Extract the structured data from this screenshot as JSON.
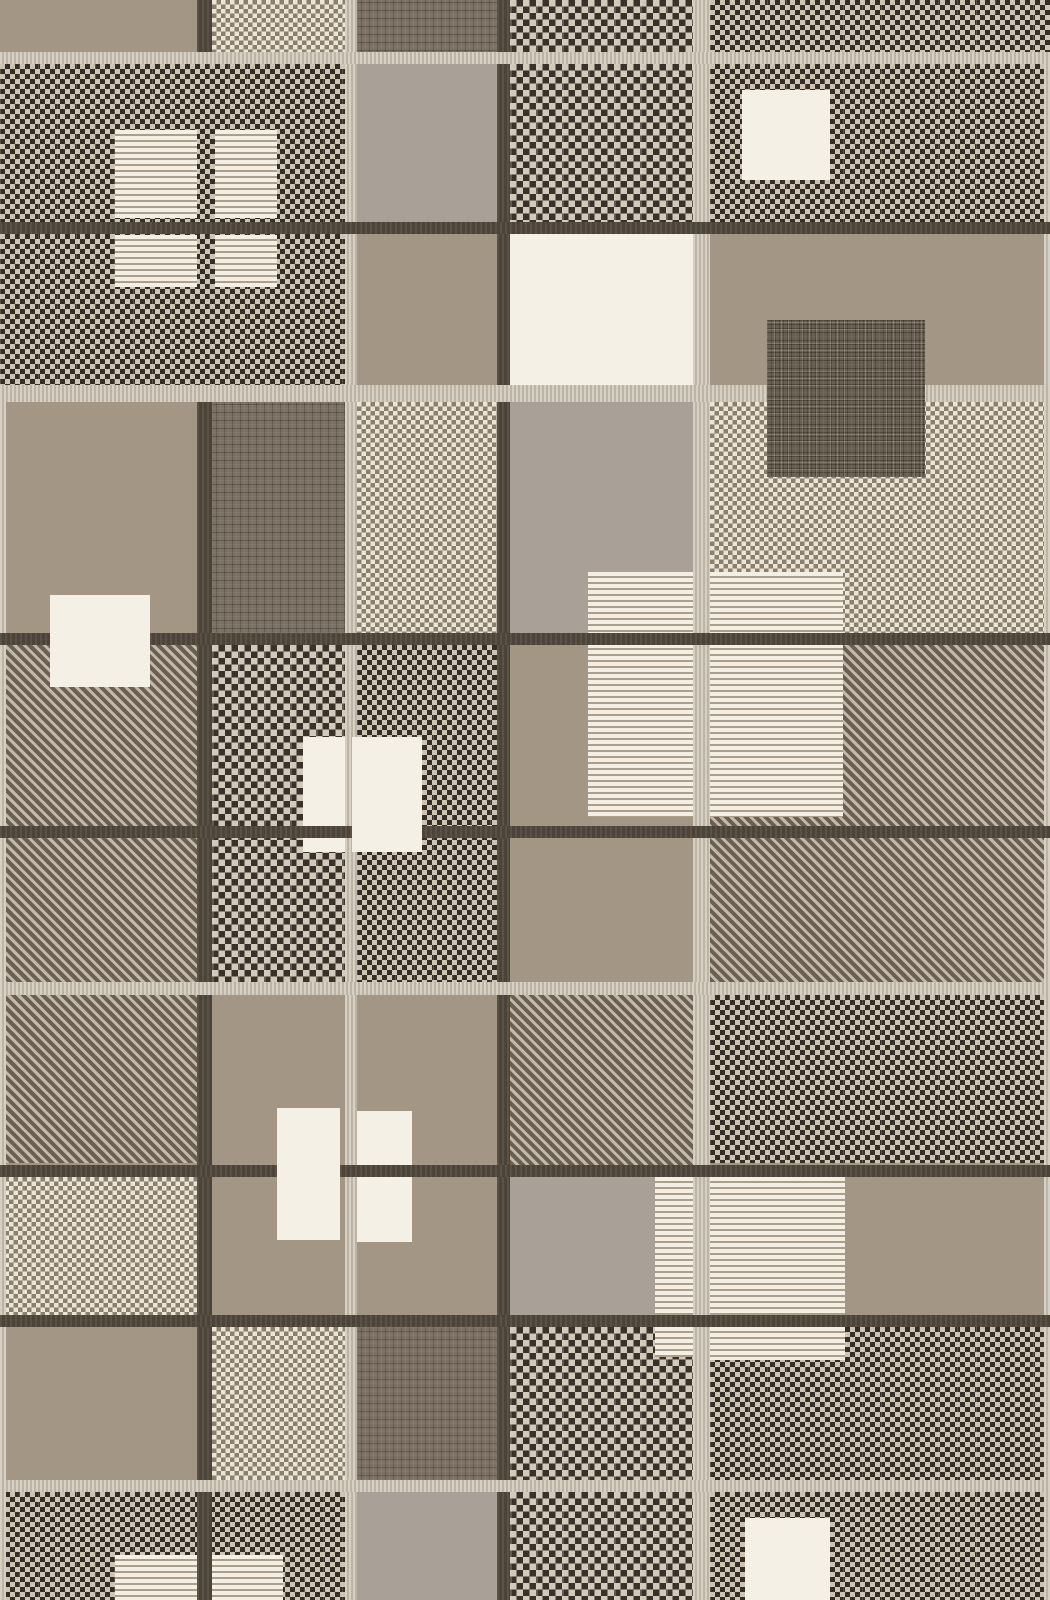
{
  "image": {
    "kind": "photograph-of-textile",
    "subject": "flat-woven plaid patchwork rug in taupe, cream and dark brown",
    "width_px": 1050,
    "height_px": 1600,
    "visible_text": "none"
  },
  "palette": {
    "taupe_solid": "#a39685",
    "gray_solid": "#a9a097",
    "cream_solid": "#f5f0e6",
    "stripe_cream": "#f4efe4",
    "stripe_gap": "#ab9f8c",
    "checker_dark_cell": "#352e26",
    "checker_light_cell": "#cdc4b5",
    "light_checker_dot": "#8b7f70",
    "twill_dark": "#6b5f51",
    "twill_light": "#c3b9aa",
    "crosshatch_base": "#7c7164",
    "crosshatch_dark_rect": "#695f52",
    "light_band": "#cbc3b5",
    "dark_band": "#4d4439"
  },
  "textures_legend": {
    "taupe": "solid taupe weave",
    "gray": "solid greige weave",
    "cream": "solid off-white patch",
    "stripe": "cream patch with horizontal taupe pinstripes",
    "checkd": "small dark-and-cream checkerboard weave",
    "checkb": "larger dark-and-cream checkerboard weave with seams",
    "checkl": "cream-dominant light checkerboard weave",
    "twill": "diagonal twill weave",
    "cross": "crosshatch grid weave",
    "crossd": "dark crosshatch grid patch",
    "bandl": "ribbed light weft band",
    "bandd": "dark brown weft band",
    "vlight": "ribbed light warp line",
    "vdark": "dark brown warp line"
  },
  "blocks": [
    {
      "name": "r1-colA-taupe",
      "x": 0,
      "y": 0,
      "w": 197,
      "h": 52,
      "tex": "taupe",
      "z": 1
    },
    {
      "name": "r1-colB-light-checker",
      "x": 212,
      "y": 0,
      "w": 133,
      "h": 52,
      "tex": "checkl",
      "z": 1
    },
    {
      "name": "r1-colC-crosshatch",
      "x": 357,
      "y": 0,
      "w": 140,
      "h": 55,
      "tex": "cross",
      "z": 1
    },
    {
      "name": "r1-colD-big-checker",
      "x": 510,
      "y": 0,
      "w": 183,
      "h": 52,
      "tex": "checkb",
      "z": 1
    },
    {
      "name": "r1-colE-dark-checker",
      "x": 710,
      "y": 0,
      "w": 340,
      "h": 52,
      "tex": "checkd",
      "z": 1
    },
    {
      "name": "r2r3-colAB-dark-checker",
      "x": 0,
      "y": 64,
      "w": 345,
      "h": 321,
      "tex": "checkd",
      "z": 1
    },
    {
      "name": "r2-colC-gray",
      "x": 357,
      "y": 64,
      "w": 140,
      "h": 158,
      "tex": "gray",
      "z": 1
    },
    {
      "name": "r2-colD-big-checker",
      "x": 510,
      "y": 64,
      "w": 183,
      "h": 158,
      "tex": "checkb",
      "z": 1
    },
    {
      "name": "r2-colE-dark-checker",
      "x": 710,
      "y": 64,
      "w": 340,
      "h": 170,
      "tex": "checkd",
      "z": 1
    },
    {
      "name": "r2-colE-cream-square",
      "x": 742,
      "y": 90,
      "w": 88,
      "h": 90,
      "tex": "cream",
      "z": 2
    },
    {
      "name": "top-striped-square-upper-left",
      "x": 115,
      "y": 130,
      "w": 82,
      "h": 88,
      "tex": "stripe",
      "z": 2
    },
    {
      "name": "top-striped-square-upper-right",
      "x": 215,
      "y": 130,
      "w": 62,
      "h": 88,
      "tex": "stripe",
      "z": 2
    },
    {
      "name": "top-striped-square-lower-left",
      "x": 115,
      "y": 235,
      "w": 82,
      "h": 52,
      "tex": "stripe",
      "z": 2
    },
    {
      "name": "top-striped-square-lower-right",
      "x": 215,
      "y": 235,
      "w": 62,
      "h": 52,
      "tex": "stripe",
      "z": 2
    },
    {
      "name": "r3-colC-taupe",
      "x": 357,
      "y": 234,
      "w": 140,
      "h": 168,
      "tex": "taupe",
      "z": 1
    },
    {
      "name": "r3-colD-big-cream-square",
      "x": 505,
      "y": 234,
      "w": 188,
      "h": 151,
      "tex": "cream",
      "z": 2
    },
    {
      "name": "r3-colE-taupe",
      "x": 710,
      "y": 234,
      "w": 340,
      "h": 151,
      "tex": "taupe",
      "z": 1
    },
    {
      "name": "colE-dark-crosshatch-rect",
      "x": 767,
      "y": 320,
      "w": 158,
      "h": 157,
      "tex": "crossd",
      "z": 4
    },
    {
      "name": "r4-colA-taupe",
      "x": 0,
      "y": 402,
      "w": 197,
      "h": 231,
      "tex": "taupe",
      "z": 1
    },
    {
      "name": "r4-colB-crosshatch",
      "x": 212,
      "y": 402,
      "w": 133,
      "h": 231,
      "tex": "cross",
      "z": 1
    },
    {
      "name": "r4-colC-light-checker",
      "x": 357,
      "y": 402,
      "w": 140,
      "h": 231,
      "tex": "checkl",
      "z": 1
    },
    {
      "name": "r4-colD-gray",
      "x": 510,
      "y": 402,
      "w": 183,
      "h": 231,
      "tex": "gray",
      "z": 1
    },
    {
      "name": "r4-colE-light-checker",
      "x": 710,
      "y": 402,
      "w": 340,
      "h": 231,
      "tex": "checkl",
      "z": 1
    },
    {
      "name": "mid-striped-block-left",
      "x": 588,
      "y": 572,
      "w": 105,
      "h": 245,
      "tex": "stripe",
      "z": 2
    },
    {
      "name": "mid-striped-block-right",
      "x": 710,
      "y": 572,
      "w": 133,
      "h": 245,
      "tex": "stripe",
      "z": 2
    },
    {
      "name": "colA-cream-rect",
      "x": 50,
      "y": 595,
      "w": 100,
      "h": 92,
      "tex": "cream",
      "z": 4
    },
    {
      "name": "r5r6-colA-twill",
      "x": 0,
      "y": 645,
      "w": 197,
      "h": 518,
      "tex": "twill",
      "z": 1
    },
    {
      "name": "r5r6-colB-big-checker",
      "x": 212,
      "y": 645,
      "w": 133,
      "h": 337,
      "tex": "checkb",
      "z": 1
    },
    {
      "name": "r5r6-colC-dark-checker",
      "x": 357,
      "y": 645,
      "w": 140,
      "h": 337,
      "tex": "checkd",
      "z": 1
    },
    {
      "name": "r5r6-colD-taupe",
      "x": 510,
      "y": 645,
      "w": 183,
      "h": 337,
      "tex": "taupe",
      "z": 1
    },
    {
      "name": "r5r6-colE-twill",
      "x": 710,
      "y": 645,
      "w": 340,
      "h": 337,
      "tex": "twill",
      "z": 1
    },
    {
      "name": "colB-cream-square-mid",
      "x": 303,
      "y": 737,
      "w": 42,
      "h": 115,
      "tex": "cream",
      "z": 2
    },
    {
      "name": "colC-cream-square-mid",
      "x": 352,
      "y": 737,
      "w": 70,
      "h": 115,
      "tex": "cream",
      "z": 4
    },
    {
      "name": "r7r8-colB-taupe",
      "x": 212,
      "y": 995,
      "w": 133,
      "h": 320,
      "tex": "taupe",
      "z": 1
    },
    {
      "name": "r7r8-colC-taupe",
      "x": 357,
      "y": 995,
      "w": 140,
      "h": 320,
      "tex": "taupe",
      "z": 1
    },
    {
      "name": "r7-colD-twill",
      "x": 510,
      "y": 995,
      "w": 183,
      "h": 170,
      "tex": "twill",
      "z": 1
    },
    {
      "name": "r7-colE-dark-checker",
      "x": 710,
      "y": 995,
      "w": 340,
      "h": 168,
      "tex": "checkd",
      "z": 1
    },
    {
      "name": "colB-cream-square-low",
      "x": 277,
      "y": 1108,
      "w": 63,
      "h": 132,
      "tex": "cream",
      "z": 4
    },
    {
      "name": "colC-cream-square-low",
      "x": 352,
      "y": 1111,
      "w": 60,
      "h": 131,
      "tex": "cream",
      "z": 2
    },
    {
      "name": "r8-colA-light-checker",
      "x": 0,
      "y": 1177,
      "w": 197,
      "h": 138,
      "tex": "checkl",
      "z": 1
    },
    {
      "name": "r8-colD-gray",
      "x": 510,
      "y": 1177,
      "w": 183,
      "h": 138,
      "tex": "gray",
      "z": 1
    },
    {
      "name": "r8-colE-taupe",
      "x": 710,
      "y": 1177,
      "w": 340,
      "h": 138,
      "tex": "taupe",
      "z": 1
    },
    {
      "name": "low-striped-block",
      "x": 710,
      "y": 1177,
      "w": 135,
      "h": 183,
      "tex": "stripe",
      "z": 2
    },
    {
      "name": "low-striped-bar",
      "x": 655,
      "y": 1177,
      "w": 38,
      "h": 180,
      "tex": "stripe",
      "z": 2
    },
    {
      "name": "r9-colA-taupe",
      "x": 0,
      "y": 1327,
      "w": 197,
      "h": 153,
      "tex": "taupe",
      "z": 1
    },
    {
      "name": "r9-colB-light-checker",
      "x": 212,
      "y": 1327,
      "w": 133,
      "h": 153,
      "tex": "checkl",
      "z": 1
    },
    {
      "name": "r9-colC-crosshatch",
      "x": 357,
      "y": 1327,
      "w": 140,
      "h": 153,
      "tex": "cross",
      "z": 1
    },
    {
      "name": "r9-colD-big-checker",
      "x": 510,
      "y": 1327,
      "w": 183,
      "h": 153,
      "tex": "checkb",
      "z": 1
    },
    {
      "name": "r9-colE-dark-checker",
      "x": 710,
      "y": 1327,
      "w": 340,
      "h": 153,
      "tex": "checkd",
      "z": 1
    },
    {
      "name": "r10-colAB-dark-checker",
      "x": 0,
      "y": 1492,
      "w": 345,
      "h": 108,
      "tex": "checkd",
      "z": 1
    },
    {
      "name": "r10-colC-gray",
      "x": 357,
      "y": 1492,
      "w": 140,
      "h": 108,
      "tex": "gray",
      "z": 1
    },
    {
      "name": "r10-colD-big-checker",
      "x": 510,
      "y": 1492,
      "w": 183,
      "h": 108,
      "tex": "checkb",
      "z": 1
    },
    {
      "name": "r10-colE-dark-checker",
      "x": 710,
      "y": 1492,
      "w": 340,
      "h": 108,
      "tex": "checkd",
      "z": 1
    },
    {
      "name": "bottom-striped-square-left",
      "x": 115,
      "y": 1555,
      "w": 82,
      "h": 45,
      "tex": "stripe",
      "z": 2
    },
    {
      "name": "bottom-striped-square-right",
      "x": 210,
      "y": 1555,
      "w": 73,
      "h": 45,
      "tex": "stripe",
      "z": 2
    },
    {
      "name": "r10-colE-cream-square",
      "x": 745,
      "y": 1518,
      "w": 85,
      "h": 82,
      "tex": "cream",
      "z": 2
    },
    {
      "name": "warp-line-dark-1-top",
      "x": 197,
      "y": 0,
      "w": 15,
      "h": 64,
      "tex": "vdark",
      "z": 2
    },
    {
      "name": "warp-line-dark-1",
      "x": 197,
      "y": 385,
      "w": 15,
      "h": 1215,
      "tex": "vdark",
      "z": 2
    },
    {
      "name": "warp-line-light-1",
      "x": 345,
      "y": 0,
      "w": 12,
      "h": 1600,
      "tex": "vlight",
      "z": 2
    },
    {
      "name": "warp-line-dark-2",
      "x": 497,
      "y": 0,
      "w": 13,
      "h": 1600,
      "tex": "vdark",
      "z": 2
    },
    {
      "name": "warp-line-light-2",
      "x": 693,
      "y": 0,
      "w": 17,
      "h": 1600,
      "tex": "vlight",
      "z": 2
    },
    {
      "name": "left-edge-light-line",
      "x": 0,
      "y": 402,
      "w": 6,
      "h": 1198,
      "tex": "vlight",
      "z": 2
    },
    {
      "name": "right-edge-light-line",
      "x": 1044,
      "y": 64,
      "w": 6,
      "h": 1536,
      "tex": "vlight",
      "z": 2
    },
    {
      "name": "weft-band-light-1",
      "x": 0,
      "y": 52,
      "w": 1050,
      "h": 12,
      "tex": "bandl",
      "z": 3
    },
    {
      "name": "weft-band-dark-1",
      "x": 0,
      "y": 222,
      "w": 1050,
      "h": 12,
      "tex": "bandd",
      "z": 3
    },
    {
      "name": "weft-band-light-2",
      "x": 0,
      "y": 385,
      "w": 1050,
      "h": 17,
      "tex": "bandl",
      "z": 3
    },
    {
      "name": "weft-band-dark-2",
      "x": 0,
      "y": 633,
      "w": 1050,
      "h": 12,
      "tex": "bandd",
      "z": 3
    },
    {
      "name": "weft-band-dark-3",
      "x": 0,
      "y": 826,
      "w": 1050,
      "h": 12,
      "tex": "bandd",
      "z": 3
    },
    {
      "name": "weft-band-light-3",
      "x": 0,
      "y": 982,
      "w": 1050,
      "h": 13,
      "tex": "bandl",
      "z": 3
    },
    {
      "name": "weft-band-dark-4",
      "x": 0,
      "y": 1165,
      "w": 1050,
      "h": 12,
      "tex": "bandd",
      "z": 3
    },
    {
      "name": "weft-band-dark-5",
      "x": 0,
      "y": 1315,
      "w": 1050,
      "h": 12,
      "tex": "bandd",
      "z": 3
    },
    {
      "name": "weft-band-light-4",
      "x": 0,
      "y": 1480,
      "w": 1050,
      "h": 12,
      "tex": "bandl",
      "z": 3
    }
  ]
}
